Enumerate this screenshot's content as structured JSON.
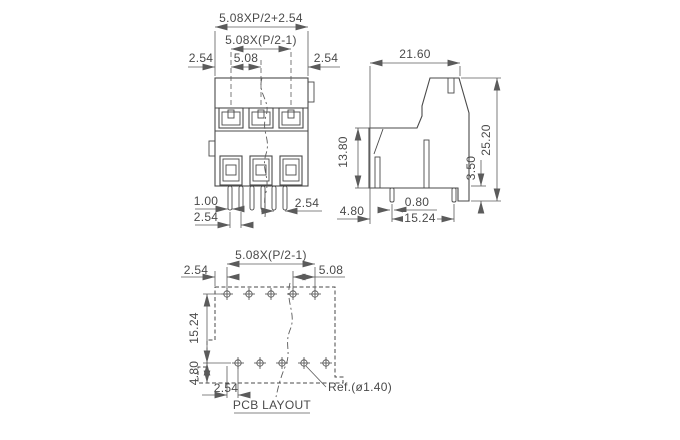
{
  "front": {
    "dim_total": "5.08XP/2+2.54",
    "dim_span": "5.08X(P/2-1)",
    "dim_left": "2.54",
    "dim_pitch": "5.08",
    "dim_right": "2.54",
    "dim_pin_width": "1.00",
    "dim_pin_pitch": "2.54",
    "dim_pin_pitch_right": "2.54"
  },
  "side": {
    "dim_width": "21.60",
    "dim_height": "25.20",
    "dim_body_height": "13.80",
    "dim_step_height": "3.50",
    "dim_pin_thickness": "0.80",
    "dim_pin_span": "15.24",
    "dim_pin_offset": "4.80"
  },
  "pcb": {
    "dim_span": "5.08X(P/2-1)",
    "dim_left": "2.54",
    "dim_pitch": "5.08",
    "dim_row_span": "15.24",
    "dim_row_offset": "4.80",
    "dim_col_offset": "2.54",
    "ref_label": "Ref.(ø1.40)",
    "title": "PCB LAYOUT"
  },
  "colors": {
    "line": "#4a4a4a",
    "dim_line": "#5b5b5b",
    "text": "#4a4a4a",
    "background": "#ffffff"
  }
}
